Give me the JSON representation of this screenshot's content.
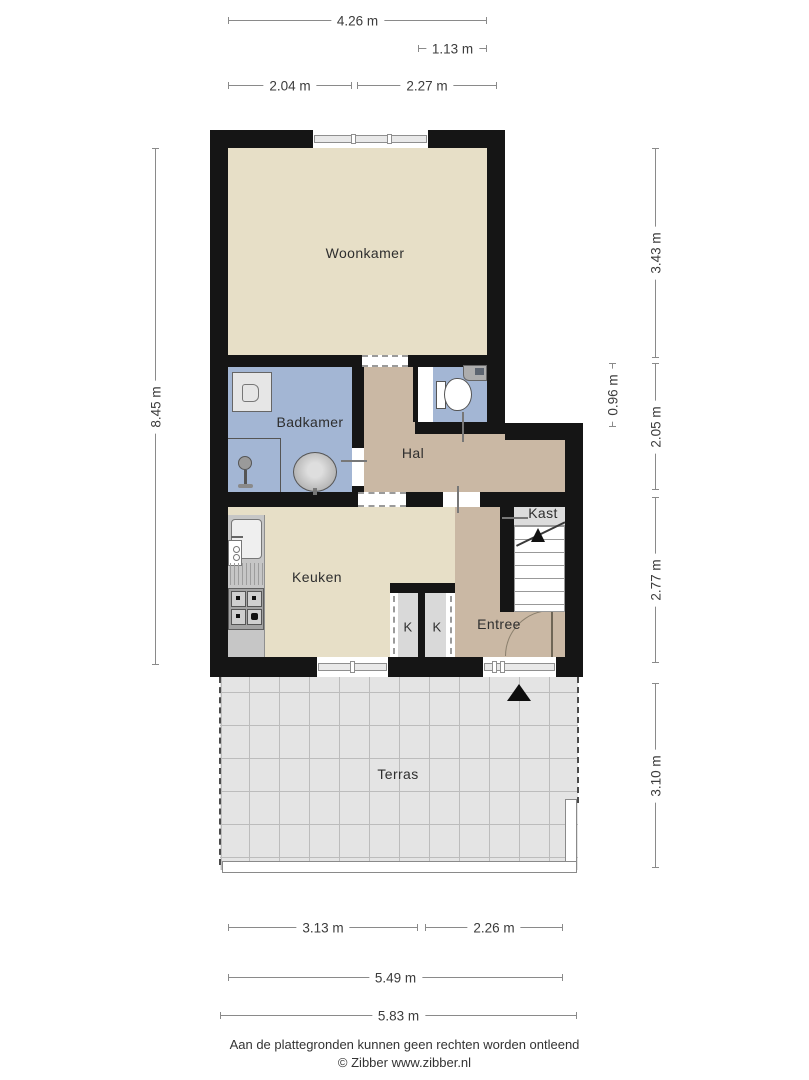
{
  "rooms": {
    "woonkamer": {
      "label": "Woonkamer"
    },
    "badkamer": {
      "label": "Badkamer"
    },
    "hal": {
      "label": "Hal"
    },
    "keuken": {
      "label": "Keuken"
    },
    "closet_left": {
      "label": "K"
    },
    "closet_right": {
      "label": "K"
    },
    "entree": {
      "label": "Entree"
    },
    "kast": {
      "label": "Kast"
    },
    "terras": {
      "label": "Terras"
    }
  },
  "dimensions": {
    "top": [
      {
        "label": "4.26 m"
      },
      {
        "label": "1.13 m"
      },
      {
        "label": "2.04 m"
      },
      {
        "label": "2.27 m"
      }
    ],
    "left": [
      {
        "label": "8.45 m"
      }
    ],
    "right": [
      {
        "label": "3.43 m"
      },
      {
        "label": "0.96 m"
      },
      {
        "label": "2.05 m"
      },
      {
        "label": "2.77 m"
      },
      {
        "label": "3.10 m"
      }
    ],
    "bottom": [
      {
        "label": "3.13 m"
      },
      {
        "label": "2.26 m"
      },
      {
        "label": "5.49 m"
      },
      {
        "label": "5.83 m"
      }
    ]
  },
  "footer": {
    "disclaimer": "Aan de plattegronden kunnen geen rechten worden ontleend",
    "copyright": "© Zibber www.zibber.nl"
  },
  "colors": {
    "wall": "#151515",
    "living_floor": "#e7dfc7",
    "bathroom_floor": "#a3b6d4",
    "hall_floor": "#cab8a4",
    "terrace_floor": "#e4e4e4",
    "closet_floor": "#dcdcdc"
  }
}
